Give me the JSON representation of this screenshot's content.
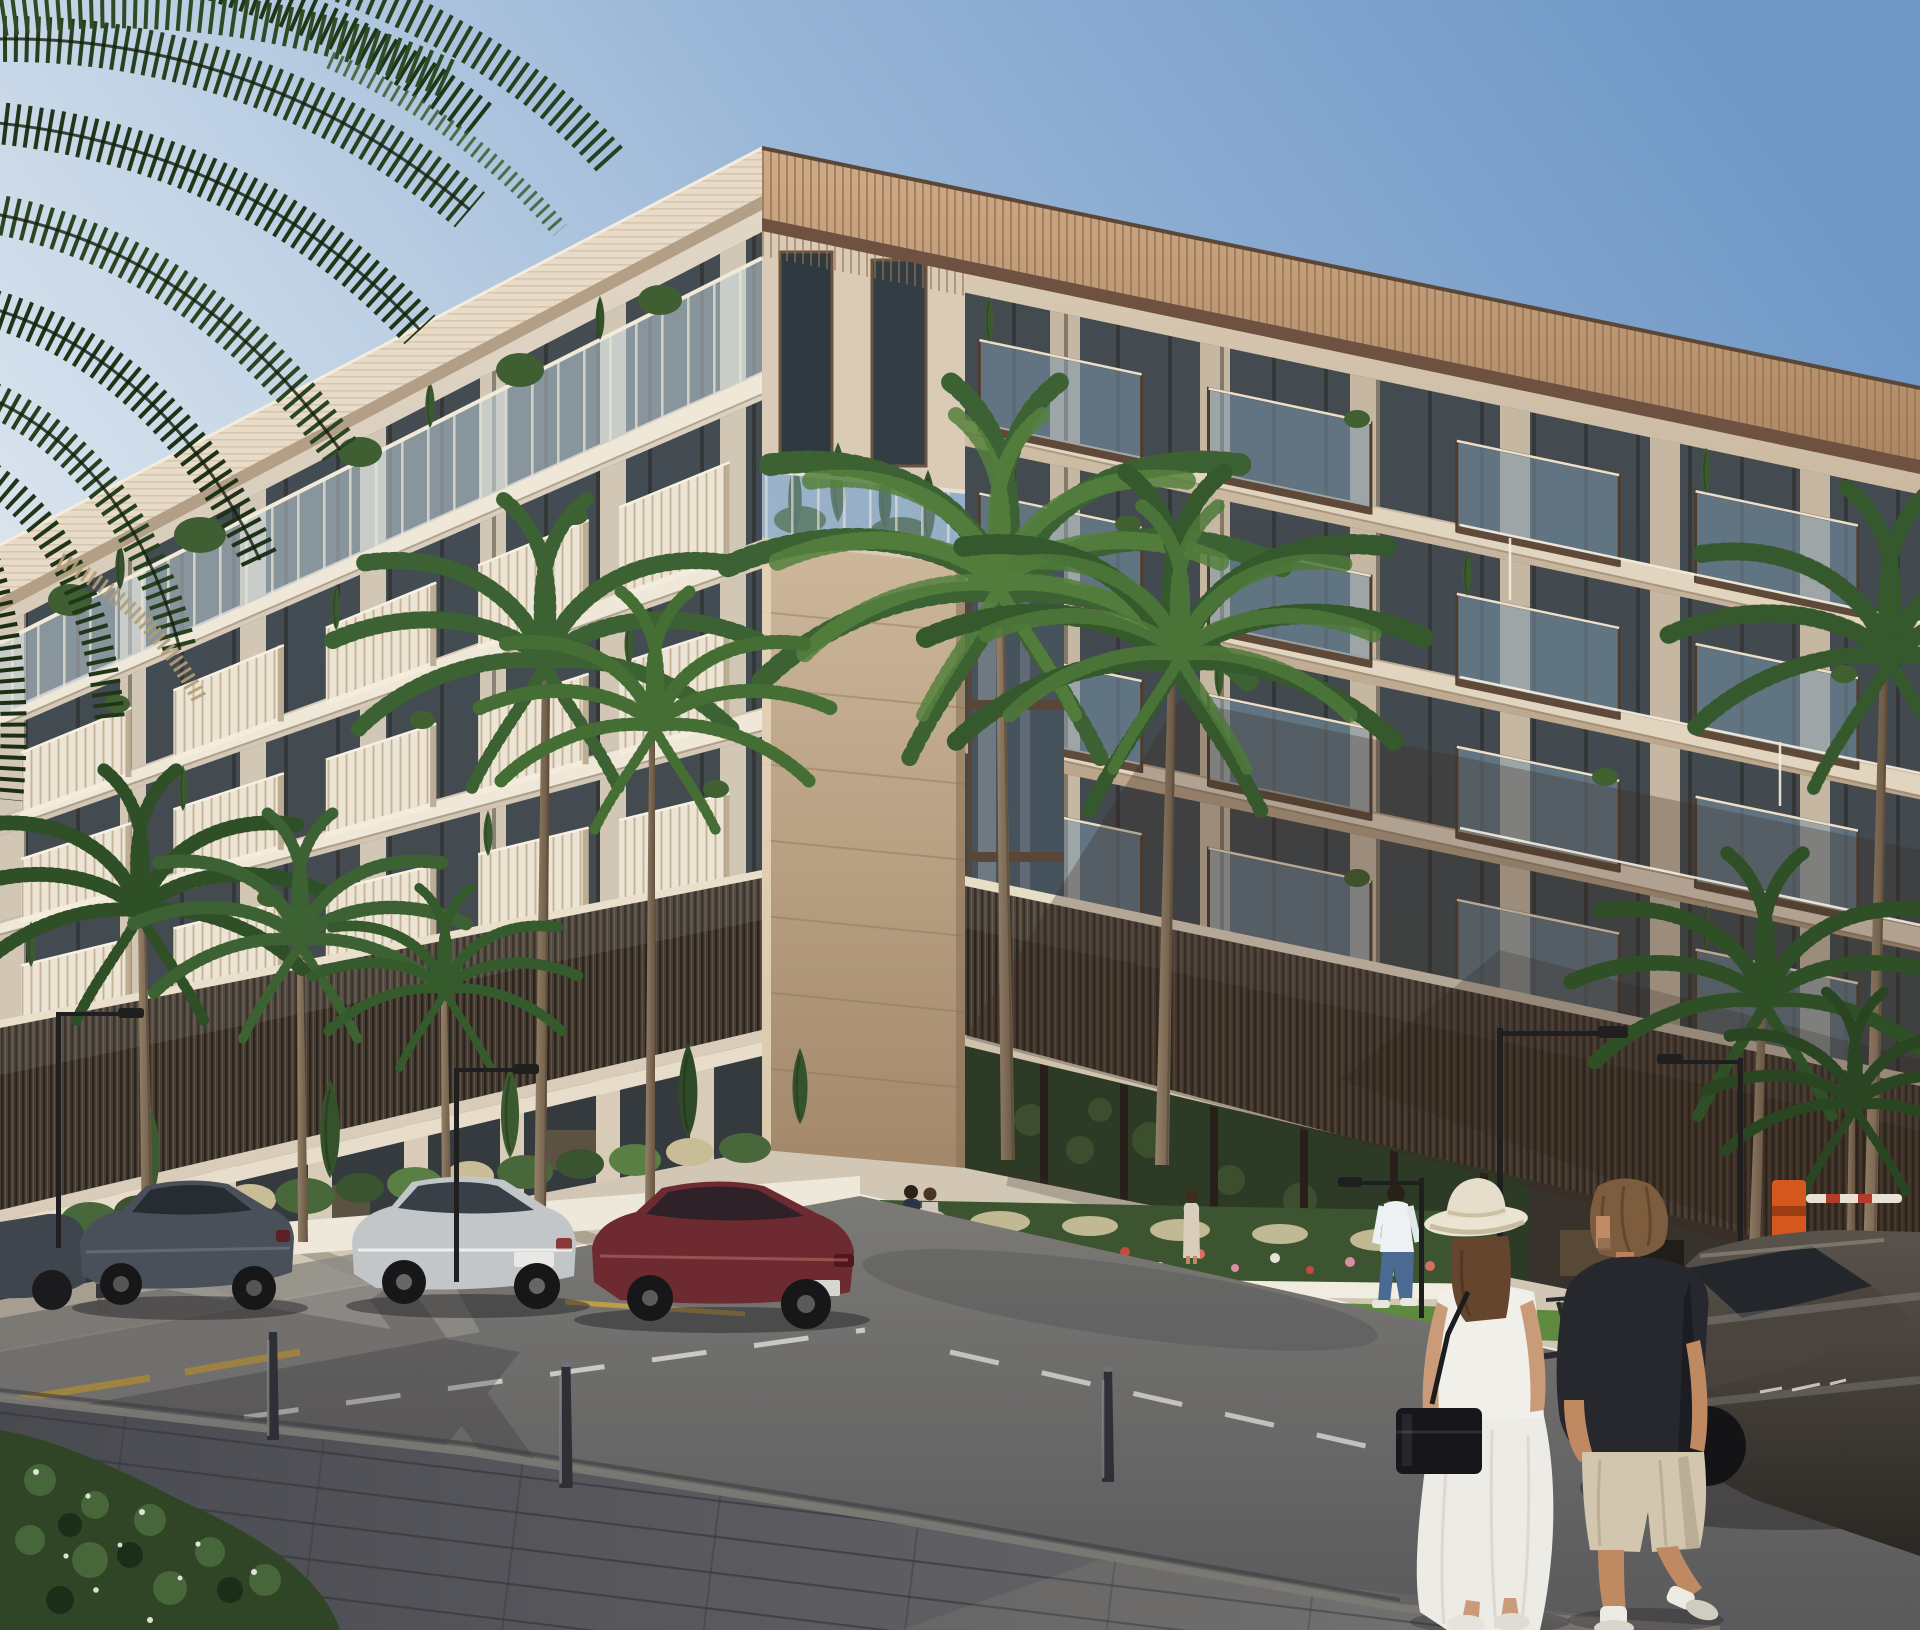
{
  "meta": {
    "title": "Architectural rendering of a modern residential corner building at golden hour",
    "type": "photoreal exterior render, street-level corner view, no visible text"
  },
  "colors": {
    "sky_deep": "#6f97c6",
    "sky_mid": "#9db9d8",
    "sky_low": "#d3dfec",
    "facade_cream": "#ddd2c2",
    "facade_warm": "#d9cbb6",
    "glass_dark": "#3b444c",
    "balcony_front": "#ece4d4",
    "slab_left": "#efe7d8",
    "slab_right": "#e2d5c0",
    "glass_balcony": "#7b98ab",
    "bronze": "#4e3d2e",
    "stone_light": "#cdb89b",
    "stone_dark": "#a88e70",
    "roof_tan": "#c5a180",
    "roof_underside": "#6e5140",
    "slat_dark": "#463c31",
    "trim_cream": "#eadfcb",
    "green_dark": "#2c4423",
    "green_mid": "#3f6030",
    "green_light": "#5d8a3e",
    "cypress": "#3c5a30",
    "trunk": "#8d7a63",
    "road": "#6f6e6c",
    "sidewalk_far": "#cfc4b0",
    "sidewalk_near": "#55565c",
    "planter_white": "#eee8da",
    "marking_white": "#d9d8d3",
    "marking_yellow": "#d2a73c",
    "car_gray": "#49505a",
    "car_silver": "#c3c6c9",
    "car_maroon": "#6d2b31",
    "car_dark": "#453e37",
    "lamp_black": "#1f1f1f",
    "barrier_orange": "#d4571e",
    "skin": "#c6987a",
    "dress_white": "#eeede7",
    "hat_cream": "#e8e1d0",
    "bag_black": "#17171b",
    "tee_dark": "#26282e",
    "shorts_khaki": "#d2c6ae",
    "jeans_blue": "#4a6a92",
    "shirt_white": "#eef1f4"
  },
  "building": {
    "left_wing": {
      "x0": 0,
      "x1": 762,
      "top0": 610,
      "top1": 205,
      "bot0": 1028,
      "bot1": 878,
      "floors": 4,
      "slots": [
        0.1,
        0.3,
        0.5,
        0.7,
        0.885
      ],
      "slot_width": 0.145,
      "balcony_rows": [
        1,
        2,
        3
      ],
      "style": "rail"
    },
    "right_wing": {
      "x0": 965,
      "x1": 1920,
      "top0": 268,
      "top1": 470,
      "bot0": 882,
      "bot1": 1080,
      "floors": 4,
      "slots": [
        0.1,
        0.34,
        0.6,
        0.85
      ],
      "slot_width": 0.17,
      "balcony_rows": [
        0,
        1,
        2,
        3
      ],
      "style": "glass"
    }
  },
  "scene": {
    "objects": [
      {
        "label": "overhanging date-palm fronds",
        "position": "top-left corner"
      },
      {
        "label": "cream residential block, 5 storeys over retail",
        "position": "center"
      },
      {
        "label": "travertine stone corner column with roof terrace",
        "position": "center"
      },
      {
        "label": "bronze slatted screen band over ground floor",
        "position": "wraps both facades"
      },
      {
        "label": "retail glazing with green wall and warm interior light",
        "position": "ground floor"
      },
      {
        "label": "ten slender palms with feathered crowns",
        "position": "along both streets"
      },
      {
        "label": "parked cars: dark grey sedan, silver hatchback, maroon fastback",
        "position": "left curb"
      },
      {
        "label": "dark car in motion",
        "position": "right, blurred"
      },
      {
        "label": "foreground couple walking: woman in white dress and sun hat with black bag, man in dark tee and khaki shorts",
        "position": "bottom right"
      },
      {
        "label": "man in white shirt and jeans crossing",
        "position": "center"
      },
      {
        "label": "flower beds with white, pink and red planting",
        "position": "building base"
      },
      {
        "label": "street lamps, bollards, kick-scooter, orange parking barrier",
        "position": "street furniture"
      },
      {
        "label": "asphalt road with white lane dashes and yellow edge marks, dark paver sidewalk",
        "position": "foreground"
      }
    ]
  }
}
